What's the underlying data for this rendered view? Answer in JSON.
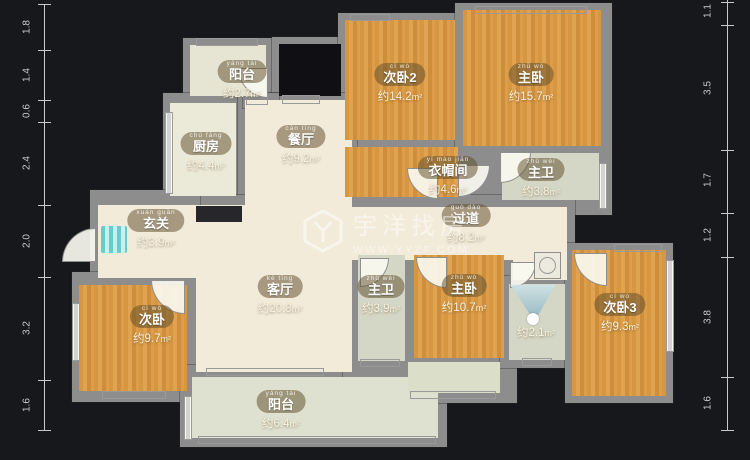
{
  "watermark": {
    "title": "宇洋找房",
    "url": "WWW.YYZF.COM",
    "logo": "hexagon-y-logo"
  },
  "rulers": {
    "left": {
      "labels": [
        "1.8",
        "1.4",
        "0.6",
        "2.4",
        "2.0",
        "3.2",
        "1.6"
      ]
    },
    "right": {
      "labels": [
        "1.1",
        "3.5",
        "1.7",
        "1.2",
        "3.8",
        "1.6"
      ]
    }
  },
  "rooms": [
    {
      "id": "balcony-top",
      "name": "阳台",
      "pinyin": "yáng tái",
      "area": "约2.7",
      "unit": "m²"
    },
    {
      "id": "kitchen",
      "name": "厨房",
      "pinyin": "chú fáng",
      "area": "约4.4",
      "unit": "m²"
    },
    {
      "id": "dining",
      "name": "餐厅",
      "pinyin": "cān tīng",
      "area": "约9.2",
      "unit": "m²"
    },
    {
      "id": "bedroom2",
      "name": "次卧2",
      "pinyin": "cì wò",
      "area": "约14.2",
      "unit": "m²"
    },
    {
      "id": "master-top",
      "name": "主卧",
      "pinyin": "zhǔ wò",
      "area": "约15.7",
      "unit": "m²"
    },
    {
      "id": "cloakroom",
      "name": "衣帽间",
      "pinyin": "yī mào jiān",
      "area": "约4.6",
      "unit": "m²"
    },
    {
      "id": "bath-top",
      "name": "主卫",
      "pinyin": "zhǔ wèi",
      "area": "约3.8",
      "unit": "m²"
    },
    {
      "id": "hallway",
      "name": "过道",
      "pinyin": "guò dào",
      "area": "约8.2",
      "unit": "m²"
    },
    {
      "id": "entry",
      "name": "玄关",
      "pinyin": "xuán guān",
      "area": "约3.9",
      "unit": "m²"
    },
    {
      "id": "living",
      "name": "客厅",
      "pinyin": "kè tīng",
      "area": "约20.8",
      "unit": "m²"
    },
    {
      "id": "bath-mid",
      "name": "主卫",
      "pinyin": "zhǔ wèi",
      "area": "约3.9",
      "unit": "m²"
    },
    {
      "id": "master-bottom",
      "name": "主卧",
      "pinyin": "zhǔ wò",
      "area": "约10.7",
      "unit": "m²"
    },
    {
      "id": "bath-small",
      "name": "",
      "pinyin": "",
      "area": "约2.1",
      "unit": "m²"
    },
    {
      "id": "bedroom3",
      "name": "次卧3",
      "pinyin": "cì wò",
      "area": "约9.3",
      "unit": "m²"
    },
    {
      "id": "bedroom-left",
      "name": "次卧",
      "pinyin": "cì wò",
      "area": "约9.7",
      "unit": "m²"
    },
    {
      "id": "balcony-bottom",
      "name": "阳台",
      "pinyin": "yáng tái",
      "area": "约6.4",
      "unit": "m²"
    }
  ]
}
